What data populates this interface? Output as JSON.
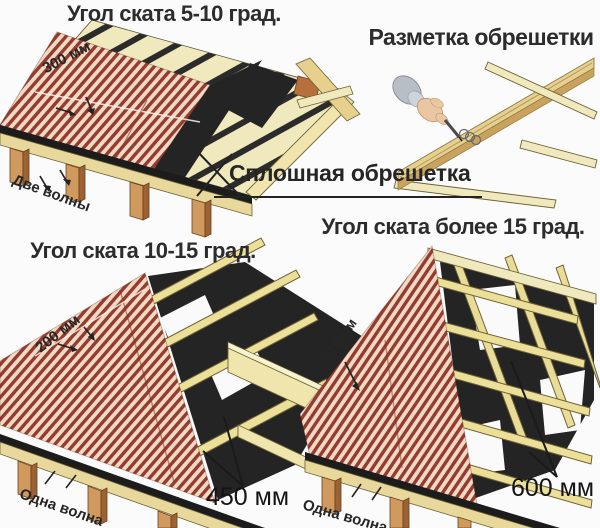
{
  "page": {
    "background": "#fbfbfb"
  },
  "colors": {
    "title": "#2c2c2c",
    "label": "#262626",
    "pointer": "#222222",
    "sheet_red": "#943c2f",
    "sheet_light": "#f0dac5",
    "board_light": "#f0e9bd",
    "board_gap": "#2b2b2b",
    "underlay": "#242424",
    "batten": "#ece099",
    "batten_edge": "#6d6136",
    "fascia": "#e9d89c",
    "post_front": "#d09a5e",
    "post_side": "#9c6233",
    "rafter": "#e7cf8d",
    "sleeve": "#b7bec6",
    "skin": "#e9c7a2"
  },
  "diagrams": {
    "low_slope": {
      "title": "Угол ската 5-10 град.",
      "overlap_length": "300 мм",
      "side_overlap": "Две волны",
      "sheathing": "Сплошная обрешетка"
    },
    "marking": {
      "title": "Разметка обрешетки"
    },
    "mid_slope": {
      "title": "Угол ската 10-15 град.",
      "overlap_length": "200 мм",
      "batten_spacing": "450 мм",
      "side_overlap": "Одна волна"
    },
    "steep_slope": {
      "title": "Угол ската более 15 град.",
      "overlap_length": "170 мм",
      "batten_spacing": "600 мм",
      "side_overlap": "Одна волна"
    }
  }
}
